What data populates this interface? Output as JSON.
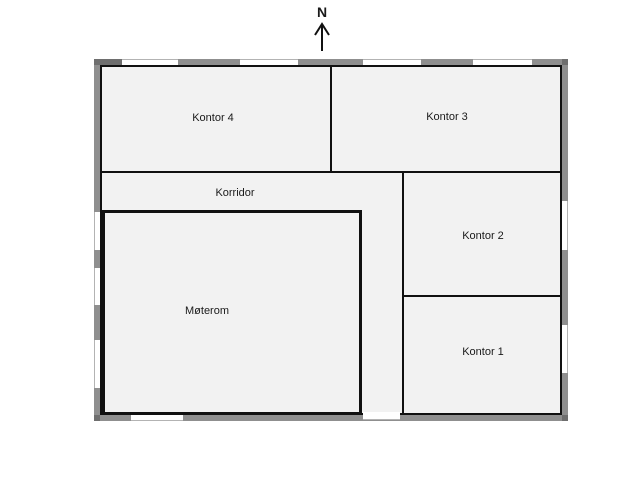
{
  "plan": {
    "type": "office-floor-plan",
    "north_indicator": {
      "label": "N"
    },
    "rooms": [
      {
        "id": "kontor4",
        "label": "Kontor 4"
      },
      {
        "id": "kontor3",
        "label": "Kontor 3"
      },
      {
        "id": "korridor",
        "label": "Korridor"
      },
      {
        "id": "kontor2",
        "label": "Kontor 2"
      },
      {
        "id": "kontor1",
        "label": "Kontor 1"
      },
      {
        "id": "moterom",
        "label": "Møterom"
      }
    ],
    "openings": {
      "windows_top": 4,
      "windows_left": 3,
      "windows_right": 2,
      "windows_bottom": 1,
      "doors_bottom": 1
    }
  },
  "colors": {
    "wall": "#8f8f8f",
    "wall_dark": "#6e6e6e",
    "room_fill": "#f2f2f2",
    "line": "#111111",
    "win_edge": "#b3b3b3",
    "text": "#1a1a1a",
    "bg": "#ffffff"
  }
}
